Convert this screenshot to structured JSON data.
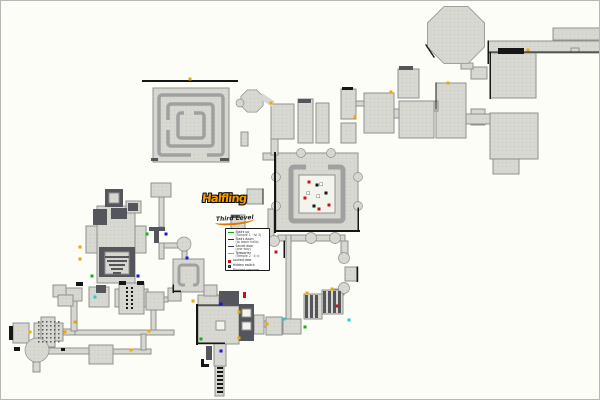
{
  "page": {
    "width": 600,
    "height": 400
  },
  "logo": {
    "title": "Halfling",
    "subtitle": "Third Level"
  },
  "legend": {
    "entries": [
      {
        "swatch": "line",
        "color": "#12b012",
        "label": "Stairs up",
        "sub": "(Temple 1 · lvl 2)"
      },
      {
        "swatch": "line",
        "color": "#1515dd",
        "label": "Stairs down",
        "sub": "(to lower halls)"
      },
      {
        "swatch": "line",
        "color": "#2a3a6a",
        "label": "Secret door",
        "sub": "(one way)"
      },
      {
        "swatch": "line",
        "color": "#19cfe0",
        "label": "Teleporter",
        "sub": "(Temple 2 · 4 c)"
      },
      {
        "swatch": "square",
        "color": "#c41515",
        "label": "Locked door",
        "sub": ""
      },
      {
        "swatch": "square-h",
        "color": "#ffffff",
        "label": "Hidden switch",
        "sub": "",
        "glyph": "H"
      },
      {
        "swatch": "square",
        "color": "#161616",
        "label": "Blocked passage",
        "sub": ""
      }
    ]
  },
  "map": {
    "colors": {
      "background": "#fdfdf8",
      "room_fill": "#d8d8d2",
      "room_dot": "#c9c9c2",
      "room_stroke": "#8f8f8f",
      "dark_fill": "#55555c",
      "mid_gray": "#a0a0a0",
      "wall": "#161616",
      "white_fill": "#f4f4ef",
      "Y": "#f0a500",
      "G": "#12b012",
      "B": "#1515dd",
      "C": "#19cfe0",
      "R": "#c41515",
      "W": "#ffffff",
      "K": "#161616"
    },
    "rooms": [
      [
        152,
        87,
        76,
        74,
        "L"
      ],
      [
        262,
        152,
        14,
        7,
        "L"
      ],
      [
        275,
        152,
        82,
        78,
        "L"
      ],
      [
        487,
        40,
        113,
        12,
        "L"
      ],
      [
        552,
        27,
        48,
        12,
        "L"
      ],
      [
        489,
        52,
        46,
        45,
        "L"
      ],
      [
        489,
        112,
        48,
        46,
        "L"
      ],
      [
        492,
        158,
        26,
        15,
        "L"
      ],
      [
        470,
        66,
        16,
        12,
        "L"
      ],
      [
        470,
        108,
        14,
        16,
        "L"
      ],
      [
        465,
        113,
        24,
        10,
        "L"
      ],
      [
        460,
        62,
        12,
        6,
        "L"
      ],
      [
        397,
        68,
        21,
        29,
        "L"
      ],
      [
        398,
        100,
        35,
        37,
        "L"
      ],
      [
        435,
        82,
        30,
        55,
        "L"
      ],
      [
        433,
        100,
        4,
        10,
        "L"
      ],
      [
        270,
        103,
        23,
        35,
        "L"
      ],
      [
        297,
        98,
        15,
        44,
        "L"
      ],
      [
        315,
        102,
        13,
        40,
        "L"
      ],
      [
        340,
        88,
        15,
        30,
        "L"
      ],
      [
        340,
        122,
        15,
        20,
        "L"
      ],
      [
        355,
        100,
        8,
        5,
        "L"
      ],
      [
        363,
        92,
        30,
        40,
        "L"
      ],
      [
        393,
        108,
        5,
        9,
        "L"
      ],
      [
        240,
        131,
        7,
        14,
        "L"
      ],
      [
        270,
        138,
        7,
        16,
        "L"
      ],
      [
        246,
        188,
        16,
        15,
        "L"
      ],
      [
        230,
        214,
        14,
        14,
        "L"
      ],
      [
        267,
        208,
        6,
        28,
        "L"
      ],
      [
        277,
        234,
        67,
        6,
        "L"
      ],
      [
        285,
        234,
        5,
        84,
        "L"
      ],
      [
        340,
        240,
        7,
        14,
        "L"
      ],
      [
        344,
        266,
        13,
        14,
        "L"
      ],
      [
        333,
        288,
        10,
        6,
        "L"
      ],
      [
        303,
        293,
        18,
        25,
        "L"
      ],
      [
        321,
        289,
        21,
        24,
        "L"
      ],
      [
        282,
        318,
        18,
        15,
        "L"
      ],
      [
        253,
        320,
        14,
        6,
        "L"
      ],
      [
        265,
        316,
        16,
        18,
        "L"
      ],
      [
        197,
        305,
        41,
        38,
        "L"
      ],
      [
        197,
        294,
        21,
        11,
        "L"
      ],
      [
        203,
        284,
        13,
        11,
        "L"
      ],
      [
        253,
        314,
        10,
        19,
        "L"
      ],
      [
        213,
        343,
        12,
        22,
        "L"
      ],
      [
        214,
        365,
        9,
        30,
        "L"
      ],
      [
        118,
        282,
        25,
        31,
        "L"
      ],
      [
        114,
        288,
        4,
        18,
        "L"
      ],
      [
        143,
        288,
        4,
        18,
        "L"
      ],
      [
        145,
        291,
        18,
        18,
        "L"
      ],
      [
        167,
        287,
        13,
        13,
        "L"
      ],
      [
        163,
        296,
        4,
        5,
        "L"
      ],
      [
        150,
        309,
        5,
        21,
        "L"
      ],
      [
        35,
        329,
        138,
        5,
        "L"
      ],
      [
        12,
        322,
        16,
        20,
        "L"
      ],
      [
        33,
        322,
        29,
        18,
        "L"
      ],
      [
        40,
        316,
        14,
        30,
        "L"
      ],
      [
        62,
        328,
        12,
        6,
        "L"
      ],
      [
        70,
        298,
        6,
        32,
        "L"
      ],
      [
        64,
        287,
        17,
        13,
        "L"
      ],
      [
        52,
        284,
        13,
        12,
        "L"
      ],
      [
        57,
        294,
        15,
        11,
        "L"
      ],
      [
        88,
        286,
        20,
        20,
        "L"
      ],
      [
        88,
        344,
        24,
        19,
        "L"
      ],
      [
        47,
        347,
        41,
        6,
        "L"
      ],
      [
        112,
        348,
        38,
        5,
        "L"
      ],
      [
        140,
        333,
        5,
        16,
        "L"
      ],
      [
        32,
        361,
        7,
        10,
        "L"
      ],
      [
        150,
        182,
        20,
        14,
        "L"
      ],
      [
        158,
        196,
        5,
        30,
        "L"
      ],
      [
        158,
        242,
        5,
        16,
        "L"
      ],
      [
        163,
        242,
        14,
        5,
        "L"
      ],
      [
        181,
        250,
        5,
        8,
        "L"
      ],
      [
        172,
        258,
        31,
        33,
        "L"
      ],
      [
        96,
        205,
        38,
        77,
        "L"
      ],
      [
        85,
        225,
        11,
        27,
        "L"
      ],
      [
        134,
        225,
        11,
        27,
        "L"
      ],
      [
        125,
        200,
        15,
        12,
        "L"
      ],
      [
        570,
        47,
        8,
        4,
        "L"
      ],
      [
        104,
        188,
        18,
        18,
        "D"
      ],
      [
        92,
        208,
        14,
        16,
        "D"
      ],
      [
        110,
        207,
        16,
        11,
        "D"
      ],
      [
        127,
        202,
        10,
        8,
        "D"
      ],
      [
        98,
        246,
        36,
        30,
        "D"
      ],
      [
        148,
        226,
        16,
        4,
        "D"
      ],
      [
        153,
        230,
        5,
        12,
        "D"
      ],
      [
        218,
        290,
        20,
        15,
        "D"
      ],
      [
        238,
        303,
        15,
        37,
        "D"
      ],
      [
        205,
        345,
        6,
        14,
        "D"
      ],
      [
        95,
        284,
        10,
        8,
        "D"
      ],
      [
        297,
        98,
        13,
        4,
        "D"
      ],
      [
        398,
        65,
        14,
        4,
        "D"
      ],
      [
        108,
        192,
        10,
        10,
        "L"
      ],
      [
        104,
        251,
        24,
        22,
        "L"
      ],
      [
        298,
        174,
        36,
        38,
        "W"
      ],
      [
        241,
        308,
        9,
        8,
        "W"
      ],
      [
        241,
        321,
        9,
        8,
        "W"
      ],
      [
        215,
        320,
        9,
        9,
        "W"
      ]
    ],
    "octagons": [
      [
        455,
        34,
        31
      ],
      [
        251,
        100,
        12
      ]
    ],
    "circles": [
      [
        183,
        243,
        7
      ],
      [
        273,
        240,
        5.5
      ],
      [
        310,
        237,
        5.5
      ],
      [
        334,
        237,
        5.5
      ],
      [
        343,
        257,
        5.5
      ],
      [
        343,
        287,
        5.5
      ],
      [
        36,
        349,
        12
      ],
      [
        239,
        102,
        4
      ],
      [
        300,
        152,
        4.5
      ],
      [
        330,
        152,
        4.5
      ],
      [
        275,
        176,
        4.5
      ],
      [
        275,
        205,
        4.5
      ],
      [
        357,
        176,
        4.5
      ],
      [
        357,
        205,
        4.5
      ]
    ],
    "thicklines": [
      [
        260,
        95,
        272,
        103,
        6
      ]
    ],
    "rings": [
      [
        158,
        94,
        64,
        60,
        3.5
      ],
      [
        167,
        103,
        45,
        42,
        3.5
      ],
      [
        177,
        112,
        26,
        25,
        3.5
      ],
      [
        290,
        166,
        52,
        54,
        5
      ],
      [
        178,
        264,
        19,
        20,
        3
      ]
    ],
    "gaps": [
      [
        190,
        149,
        16,
        7
      ],
      [
        164,
        119,
        7,
        10
      ],
      [
        183,
        109,
        10,
        6
      ],
      [
        305,
        162,
        22,
        7
      ],
      [
        184,
        281,
        8,
        5
      ]
    ],
    "bars": [
      [
        497,
        47,
        26,
        6,
        "K"
      ],
      [
        341,
        86,
        11,
        3,
        "K"
      ],
      [
        8,
        325,
        4,
        14,
        "K"
      ],
      [
        13,
        346,
        6,
        4,
        "K"
      ],
      [
        60,
        347,
        4,
        3,
        "K"
      ],
      [
        75,
        281,
        7,
        4,
        "K"
      ],
      [
        118,
        280,
        7,
        4,
        "K"
      ],
      [
        136,
        280,
        7,
        4,
        "K"
      ],
      [
        230,
        214,
        9,
        3,
        "D"
      ],
      [
        242,
        291,
        3,
        6,
        "R"
      ],
      [
        216,
        366,
        6,
        2,
        "K"
      ],
      [
        216,
        370,
        6,
        2,
        "K"
      ],
      [
        216,
        374,
        6,
        2,
        "K"
      ],
      [
        216,
        378,
        6,
        2,
        "K"
      ],
      [
        216,
        382,
        6,
        2,
        "K"
      ],
      [
        216,
        386,
        6,
        2,
        "K"
      ],
      [
        216,
        390,
        6,
        2,
        "K"
      ],
      [
        200,
        358,
        3,
        8,
        "K"
      ],
      [
        200,
        363,
        8,
        3,
        "K"
      ],
      [
        304,
        294,
        3,
        23,
        "D"
      ],
      [
        309,
        294,
        3,
        23,
        "D"
      ],
      [
        314,
        294,
        3,
        23,
        "D"
      ],
      [
        322,
        290,
        3,
        22,
        "D"
      ],
      [
        327,
        290,
        3,
        22,
        "D"
      ],
      [
        332,
        290,
        3,
        22,
        "D"
      ],
      [
        337,
        290,
        3,
        22,
        "D"
      ],
      [
        104,
        255,
        24,
        2,
        "D"
      ],
      [
        106,
        259,
        20,
        2,
        "D"
      ],
      [
        108,
        263,
        16,
        2,
        "D"
      ],
      [
        110,
        267,
        12,
        2,
        "D"
      ],
      [
        112,
        271,
        8,
        2,
        "D"
      ],
      [
        150,
        157,
        7,
        3,
        "D"
      ],
      [
        219,
        157,
        9,
        3,
        "D"
      ]
    ],
    "walls": [
      [
        142,
        80,
        236,
        80,
        2
      ],
      [
        274,
        152,
        274,
        231,
        2
      ],
      [
        274,
        230,
        358,
        230,
        2
      ],
      [
        357,
        207,
        357,
        230,
        1.5
      ],
      [
        487,
        51,
        600,
        51,
        1.2
      ],
      [
        489,
        52,
        489,
        97,
        1.5
      ],
      [
        487,
        40,
        487,
        62,
        1.5
      ],
      [
        196,
        304,
        196,
        343,
        2
      ],
      [
        196,
        342,
        223,
        342,
        1.5
      ],
      [
        197,
        304,
        218,
        304,
        1.2
      ],
      [
        283,
        240,
        283,
        256,
        1.5
      ],
      [
        356,
        266,
        356,
        280,
        1.5
      ],
      [
        425,
        44,
        433,
        56,
        1.5
      ],
      [
        262,
        188,
        262,
        203,
        1.2
      ],
      [
        435,
        82,
        435,
        108,
        1.2
      ],
      [
        172,
        284,
        172,
        291,
        1.5
      ],
      [
        172,
        290,
        179,
        290,
        1.5
      ]
    ],
    "dotgrids": [
      {
        "x": 125,
        "y": 286,
        "cols": 2,
        "rows": 6,
        "sx": 5,
        "sy": 4,
        "s": 2,
        "c": "K"
      },
      {
        "x": 37,
        "y": 320,
        "cols": 6,
        "rows": 6,
        "sx": 4,
        "sy": 4,
        "s": 1.5,
        "c": "D"
      }
    ],
    "markers": [
      [
        189,
        78,
        "Y"
      ],
      [
        527,
        49,
        "Y"
      ],
      [
        354,
        116,
        "Y"
      ],
      [
        390,
        91,
        "Y"
      ],
      [
        447,
        82,
        "Y"
      ],
      [
        270,
        102,
        "Y"
      ],
      [
        79,
        246,
        "Y"
      ],
      [
        79,
        258,
        "Y"
      ],
      [
        29,
        331,
        "Y"
      ],
      [
        64,
        331,
        "Y"
      ],
      [
        74,
        321,
        "Y"
      ],
      [
        148,
        330,
        "Y"
      ],
      [
        130,
        349,
        "Y"
      ],
      [
        192,
        300,
        "Y"
      ],
      [
        238,
        311,
        "Y"
      ],
      [
        238,
        337,
        "Y"
      ],
      [
        266,
        323,
        "Y"
      ],
      [
        306,
        292,
        "Y"
      ],
      [
        331,
        288,
        "Y"
      ],
      [
        91,
        275,
        "G"
      ],
      [
        146,
        233,
        "G"
      ],
      [
        200,
        338,
        "G"
      ],
      [
        304,
        326,
        "G"
      ],
      [
        137,
        275,
        "B"
      ],
      [
        165,
        233,
        "B"
      ],
      [
        186,
        257,
        "B"
      ],
      [
        220,
        303,
        "B"
      ],
      [
        220,
        350,
        "B"
      ],
      [
        94,
        296,
        "C"
      ],
      [
        283,
        318,
        "C"
      ],
      [
        348,
        319,
        "C"
      ],
      [
        275,
        251,
        "R"
      ],
      [
        336,
        305,
        "R"
      ],
      [
        308,
        181,
        "R"
      ],
      [
        304,
        197,
        "R"
      ],
      [
        328,
        204,
        "R"
      ],
      [
        318,
        208,
        "R"
      ],
      [
        320,
        183,
        "W"
      ],
      [
        307,
        192,
        "W"
      ],
      [
        317,
        195,
        "W"
      ],
      [
        316,
        184,
        "K"
      ],
      [
        325,
        192,
        "K"
      ],
      [
        313,
        205,
        "K"
      ]
    ]
  }
}
